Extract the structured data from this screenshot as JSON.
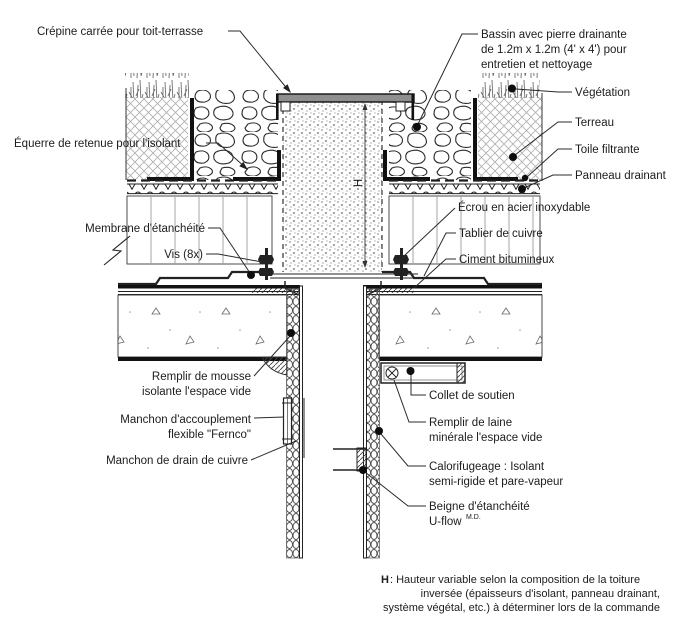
{
  "colors": {
    "paper": "#ffffff",
    "ink": "#222222",
    "cap_gray": "#8f8f8f",
    "hatch_gray": "#b0b0b0"
  },
  "callouts": {
    "crepine": {
      "lines": [
        "Crépine carrée pour toit-terrasse"
      ]
    },
    "bassin": {
      "lines": [
        "Bassin avec pierre drainante",
        "de 1.2m x 1.2m (4' x 4') pour",
        "entretien et nettoyage"
      ]
    },
    "vegetation": {
      "lines": [
        "Végétation"
      ]
    },
    "terreau": {
      "lines": [
        "Terreau"
      ]
    },
    "toile": {
      "lines": [
        "Toile filtrante"
      ]
    },
    "panneau": {
      "lines": [
        "Panneau drainant"
      ]
    },
    "equerre": {
      "lines": [
        "Équerre de retenue pour l'isolant"
      ]
    },
    "ecrou": {
      "lines": [
        "Écrou en acier inoxydable"
      ]
    },
    "tablier": {
      "lines": [
        "Tablier de cuivre"
      ]
    },
    "ciment": {
      "lines": [
        "Ciment bitumineux"
      ]
    },
    "membrane": {
      "lines": [
        "Membrane d'étanchéité"
      ]
    },
    "vis": {
      "lines": [
        "Vis (8x)"
      ]
    },
    "mousse": {
      "lines": [
        "Remplir de mousse",
        "isolante l'espace vide"
      ]
    },
    "fernco": {
      "lines": [
        "Manchon d'accouplement",
        "flexible \"Fernco\""
      ]
    },
    "manchon_drain": {
      "lines": [
        "Manchon de drain de cuivre"
      ]
    },
    "collet": {
      "lines": [
        "Collet de soutien"
      ]
    },
    "laine": {
      "lines": [
        "Remplir de laine",
        "minérale l'espace vide"
      ]
    },
    "calorifugeage": {
      "lines": [
        "Calorifugeage : Isolant",
        "semi-rigide et pare-vapeur"
      ]
    },
    "beigne": {
      "lines": [
        "Beigne d'étanchéité"
      ],
      "product": "U-flow",
      "trademark": "M.D."
    },
    "dimension_h": "H"
  },
  "footnote": {
    "bold_prefix": "H",
    "line1_rest": " : Hauteur variable selon la composition de la toiture",
    "line2": "inversée (épaisseurs d'isolant, panneau drainant,",
    "line3": "système végétal, etc.) à déterminer lors de la commande"
  }
}
